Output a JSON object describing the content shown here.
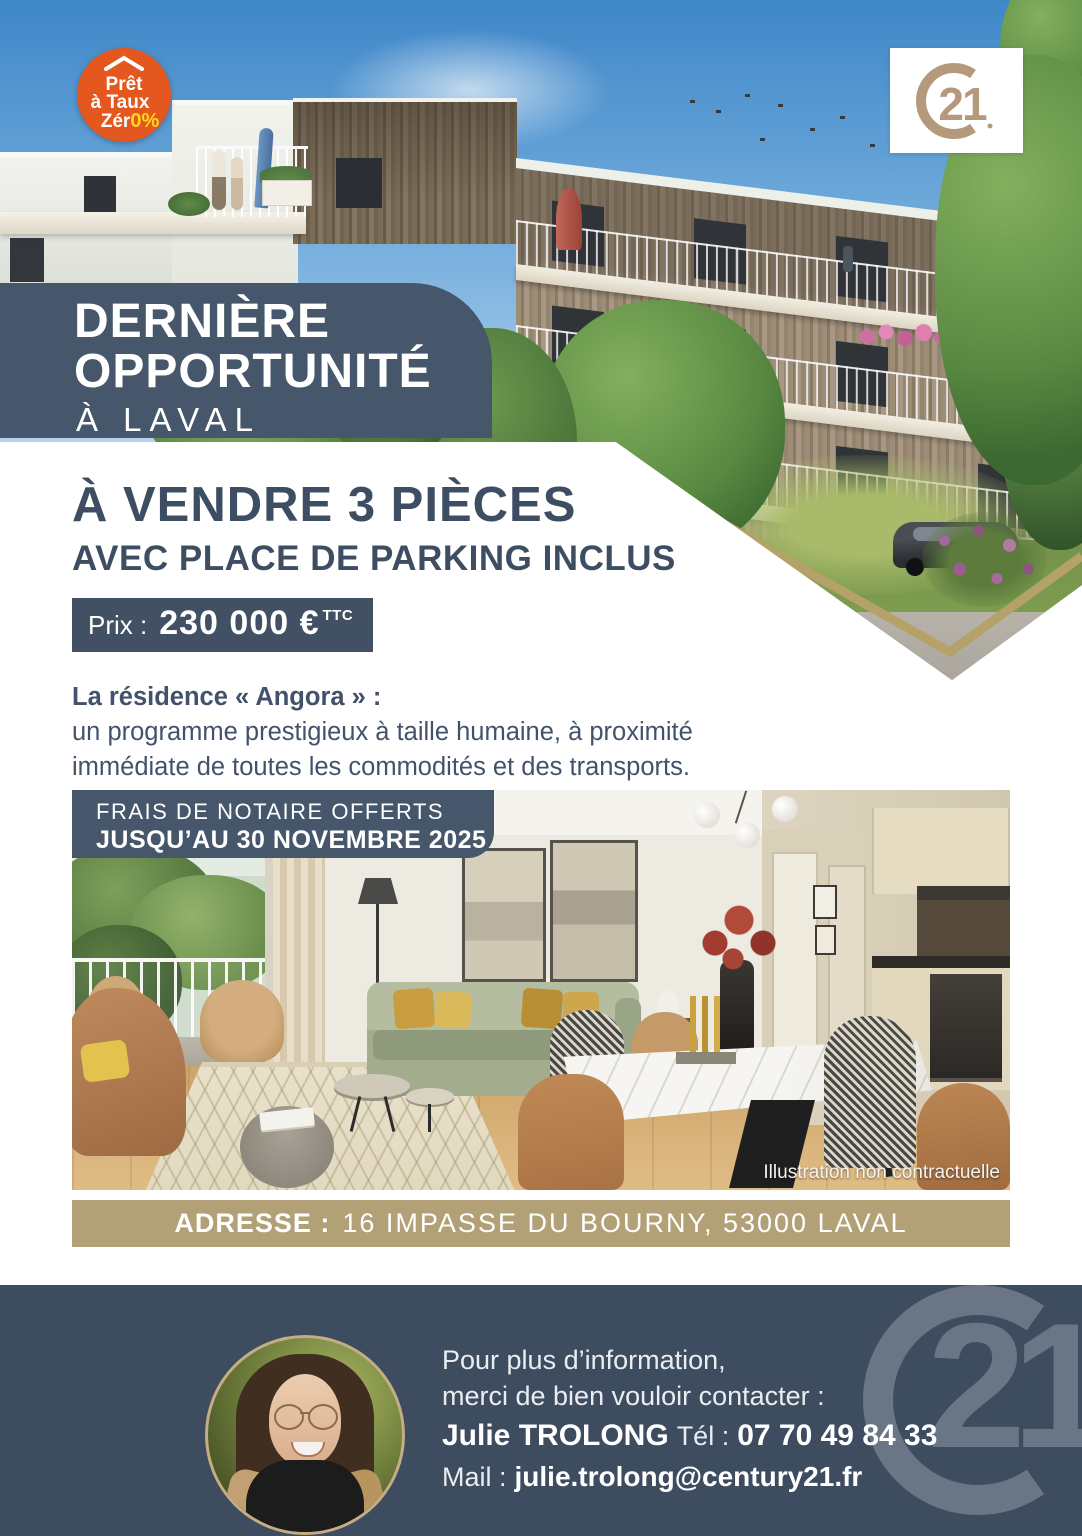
{
  "ptz_badge": {
    "line1": "Prêt",
    "line2": "à Taux",
    "line3": "Zér",
    "suffix": "0%"
  },
  "logo": {
    "digits": "21"
  },
  "ribbon": {
    "line1": "DERNIÈRE",
    "line2": "OPPORTUNITÉ",
    "line3": "À LAVAL"
  },
  "listing": {
    "title": "À VENDRE 3 PIÈCES",
    "subtitle": "AVEC PLACE DE PARKING INCLUS",
    "price_label": "Prix :",
    "price": "230 000 €",
    "price_suffix": "TTC"
  },
  "description": {
    "intro": "La résidence « Angora » :",
    "line1": "un programme prestigieux à taille humaine, à proximité",
    "line2": "immédiate de toutes les commodités et des transports."
  },
  "promo": {
    "line1": "FRAIS DE NOTAIRE OFFERTS",
    "line2": "JUSQU’AU 30 NOVEMBRE 2025"
  },
  "photo": {
    "caption": "Illustration non contractuelle"
  },
  "address": {
    "label": "ADRESSE :",
    "value": "16 IMPASSE DU BOURNY, 53000 LAVAL"
  },
  "footer": {
    "info1": "Pour plus d’information,",
    "info2": "merci de bien vouloir contacter :",
    "agent_name": "Julie TROLONG",
    "tel_label": "Tél :",
    "tel": "07 70 49 84 33",
    "mail_label": "Mail :",
    "mail": "julie.trolong@century21.fr"
  },
  "colors": {
    "slate_banner": "#46566b",
    "slate_price": "#415062",
    "slate_footer": "#3e4c60",
    "heading_text": "#3d4e63",
    "gold_bar": "#b2a077",
    "logo_gold": "#b49a7b",
    "ptz_orange": "#e4571f",
    "ptz_yellow": "#ffd51e"
  }
}
